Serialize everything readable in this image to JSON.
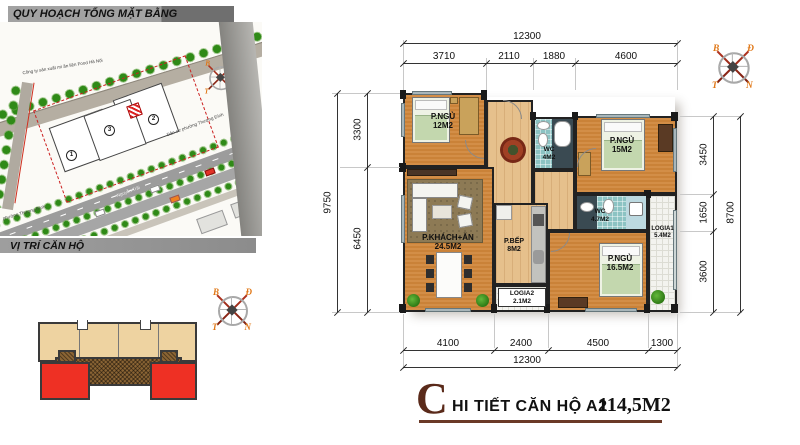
{
  "left_panel": {
    "header_master_plan": "QUY HOẠCH TỔNG MẶT BẰNG",
    "header_location": "VỊ TRÍ CĂN HỘ",
    "site_plan": {
      "label_company": "Công ty sản xuất mì ăn liền Food Hà Nội",
      "label_residential": "Dân cư phường Thượng Đình",
      "label_ward": "phường Thượng Đình",
      "label_street": "Nguyễn Trãi",
      "building_numbers": [
        "1",
        "2",
        "3"
      ]
    }
  },
  "compass": {
    "north": "B",
    "east": "Đ",
    "south": "N",
    "west": "T"
  },
  "plan": {
    "rooms": {
      "bedroom1": {
        "name": "P.NGỦ",
        "area": "12M2"
      },
      "bedroom2": {
        "name": "P.NGỦ",
        "area": "15M2"
      },
      "bedroom3": {
        "name": "P.NGỦ",
        "area": "16.5M2"
      },
      "wc1": {
        "name": "WC",
        "area": "4M2"
      },
      "wc2": {
        "name": "WC",
        "area": "4.7M2"
      },
      "logia1": {
        "name": "LOGIA1",
        "area": "5.4M2"
      },
      "logia2": {
        "name": "LOGIA2",
        "area": "2.1M2"
      },
      "living": {
        "name": "P.KHÁCH+ĂN",
        "area": "24.5M2"
      },
      "kitchen": {
        "name": "P.BẾP",
        "area": "8M2"
      }
    },
    "dims": {
      "top_total": "12300",
      "top": [
        "3710",
        "2110",
        "1880",
        "4600"
      ],
      "bottom": [
        "4100",
        "2400",
        "4500",
        "1300"
      ],
      "bottom_total": "12300",
      "left": [
        "3300",
        "6450"
      ],
      "left_total": "9750",
      "right": [
        "3450",
        "1650",
        "3600"
      ],
      "right_total": "8700"
    }
  },
  "title": {
    "initial": "C",
    "text": "HI TIẾT CĂN HỘ A2",
    "area": "114,5M2"
  },
  "colors": {
    "accent_maroon": "#6b3a28",
    "floor_orange": "#d0873c",
    "tile_teal": "#8cc3c3",
    "highlight_red": "#ee3024"
  }
}
